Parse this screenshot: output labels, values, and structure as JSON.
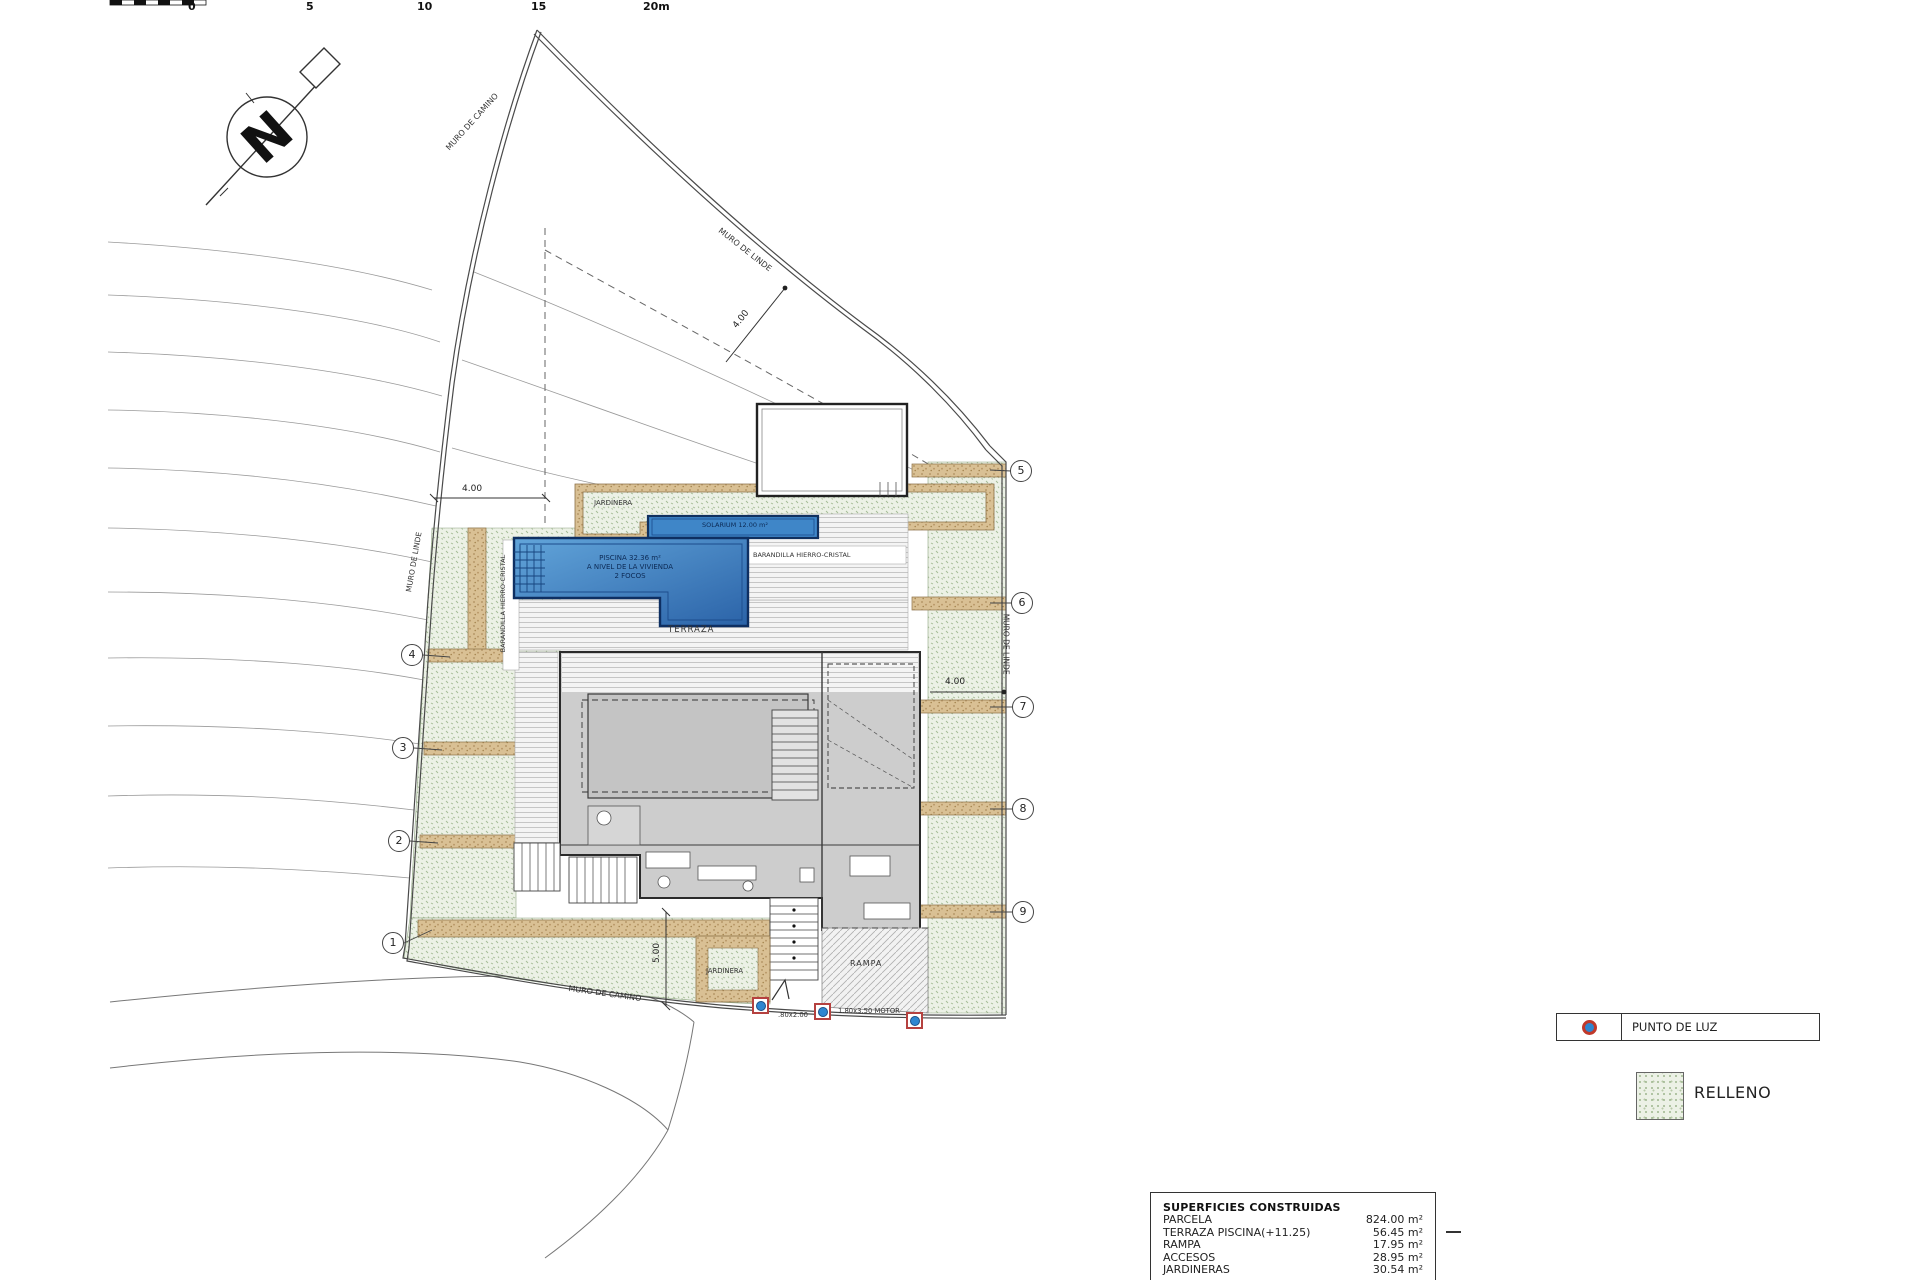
{
  "scale_bar": {
    "ticks": [
      "0",
      "5",
      "10",
      "15",
      "20m"
    ]
  },
  "compass": {
    "north": "N"
  },
  "boundaries": {
    "muro_camino_top": "MURO DE CAMINO",
    "muro_linde_topright": "MURO DE LINDE",
    "muro_linde_left": "MURO DE LINDE",
    "muro_linde_right": "MURO DE LINDE",
    "muro_camino_bottom": "MURO DE CAMINO"
  },
  "dimensions": {
    "left_setback": "4.00",
    "topright_setback": "4.00",
    "right_setback": "4.00",
    "bottom_height": "5.00"
  },
  "pool": {
    "solarium": "SOLARIUM 12.00 m²",
    "line1": "PISCINA 32.36 m²",
    "line2": "A NIVEL DE LA VIVIENDA",
    "line3": "2 FOCOS"
  },
  "areas": {
    "terraza": "TERRAZA",
    "rampa": "RAMPA",
    "jardinera_top": "JARDINERA",
    "jardinera_bottom": "JARDINERA",
    "barandilla_h": "BARANDILLA HIERRO-CRISTAL",
    "barandilla_v": "BARANDILLA HIERRO-CRISTAL",
    "gate_note": ".80x2.00",
    "motor_note": "1.80x3.50 MOTOR"
  },
  "markers": {
    "m1": "1",
    "m2": "2",
    "m3": "3",
    "m4": "4",
    "m5": "5",
    "m6": "6",
    "m7": "7",
    "m8": "8",
    "m9": "9"
  },
  "legend": {
    "punto_de_luz": "PUNTO DE LUZ",
    "relleno": "RELLENO"
  },
  "table": {
    "title": "SUPERFICIES CONSTRUIDAS",
    "rows": [
      {
        "label": "PARCELA",
        "value": "824.00 m²"
      },
      {
        "label": "TERRAZA PISCINA(+11.25)",
        "value": "56.45 m²"
      },
      {
        "label": "RAMPA",
        "value": "17.95 m²"
      },
      {
        "label": "ACCESOS",
        "value": "28.95 m²"
      },
      {
        "label": "JARDINERAS",
        "value": "30.54 m²"
      }
    ]
  },
  "colors": {
    "pool_blue_light": "#62a5da",
    "pool_blue_dark": "#2b63a8",
    "pool_border": "#10305f",
    "relleno_green": "#a3ba94",
    "muro_tan": "#d9c094",
    "light_red": "#b5413f",
    "light_blue": "#2e86d0"
  }
}
